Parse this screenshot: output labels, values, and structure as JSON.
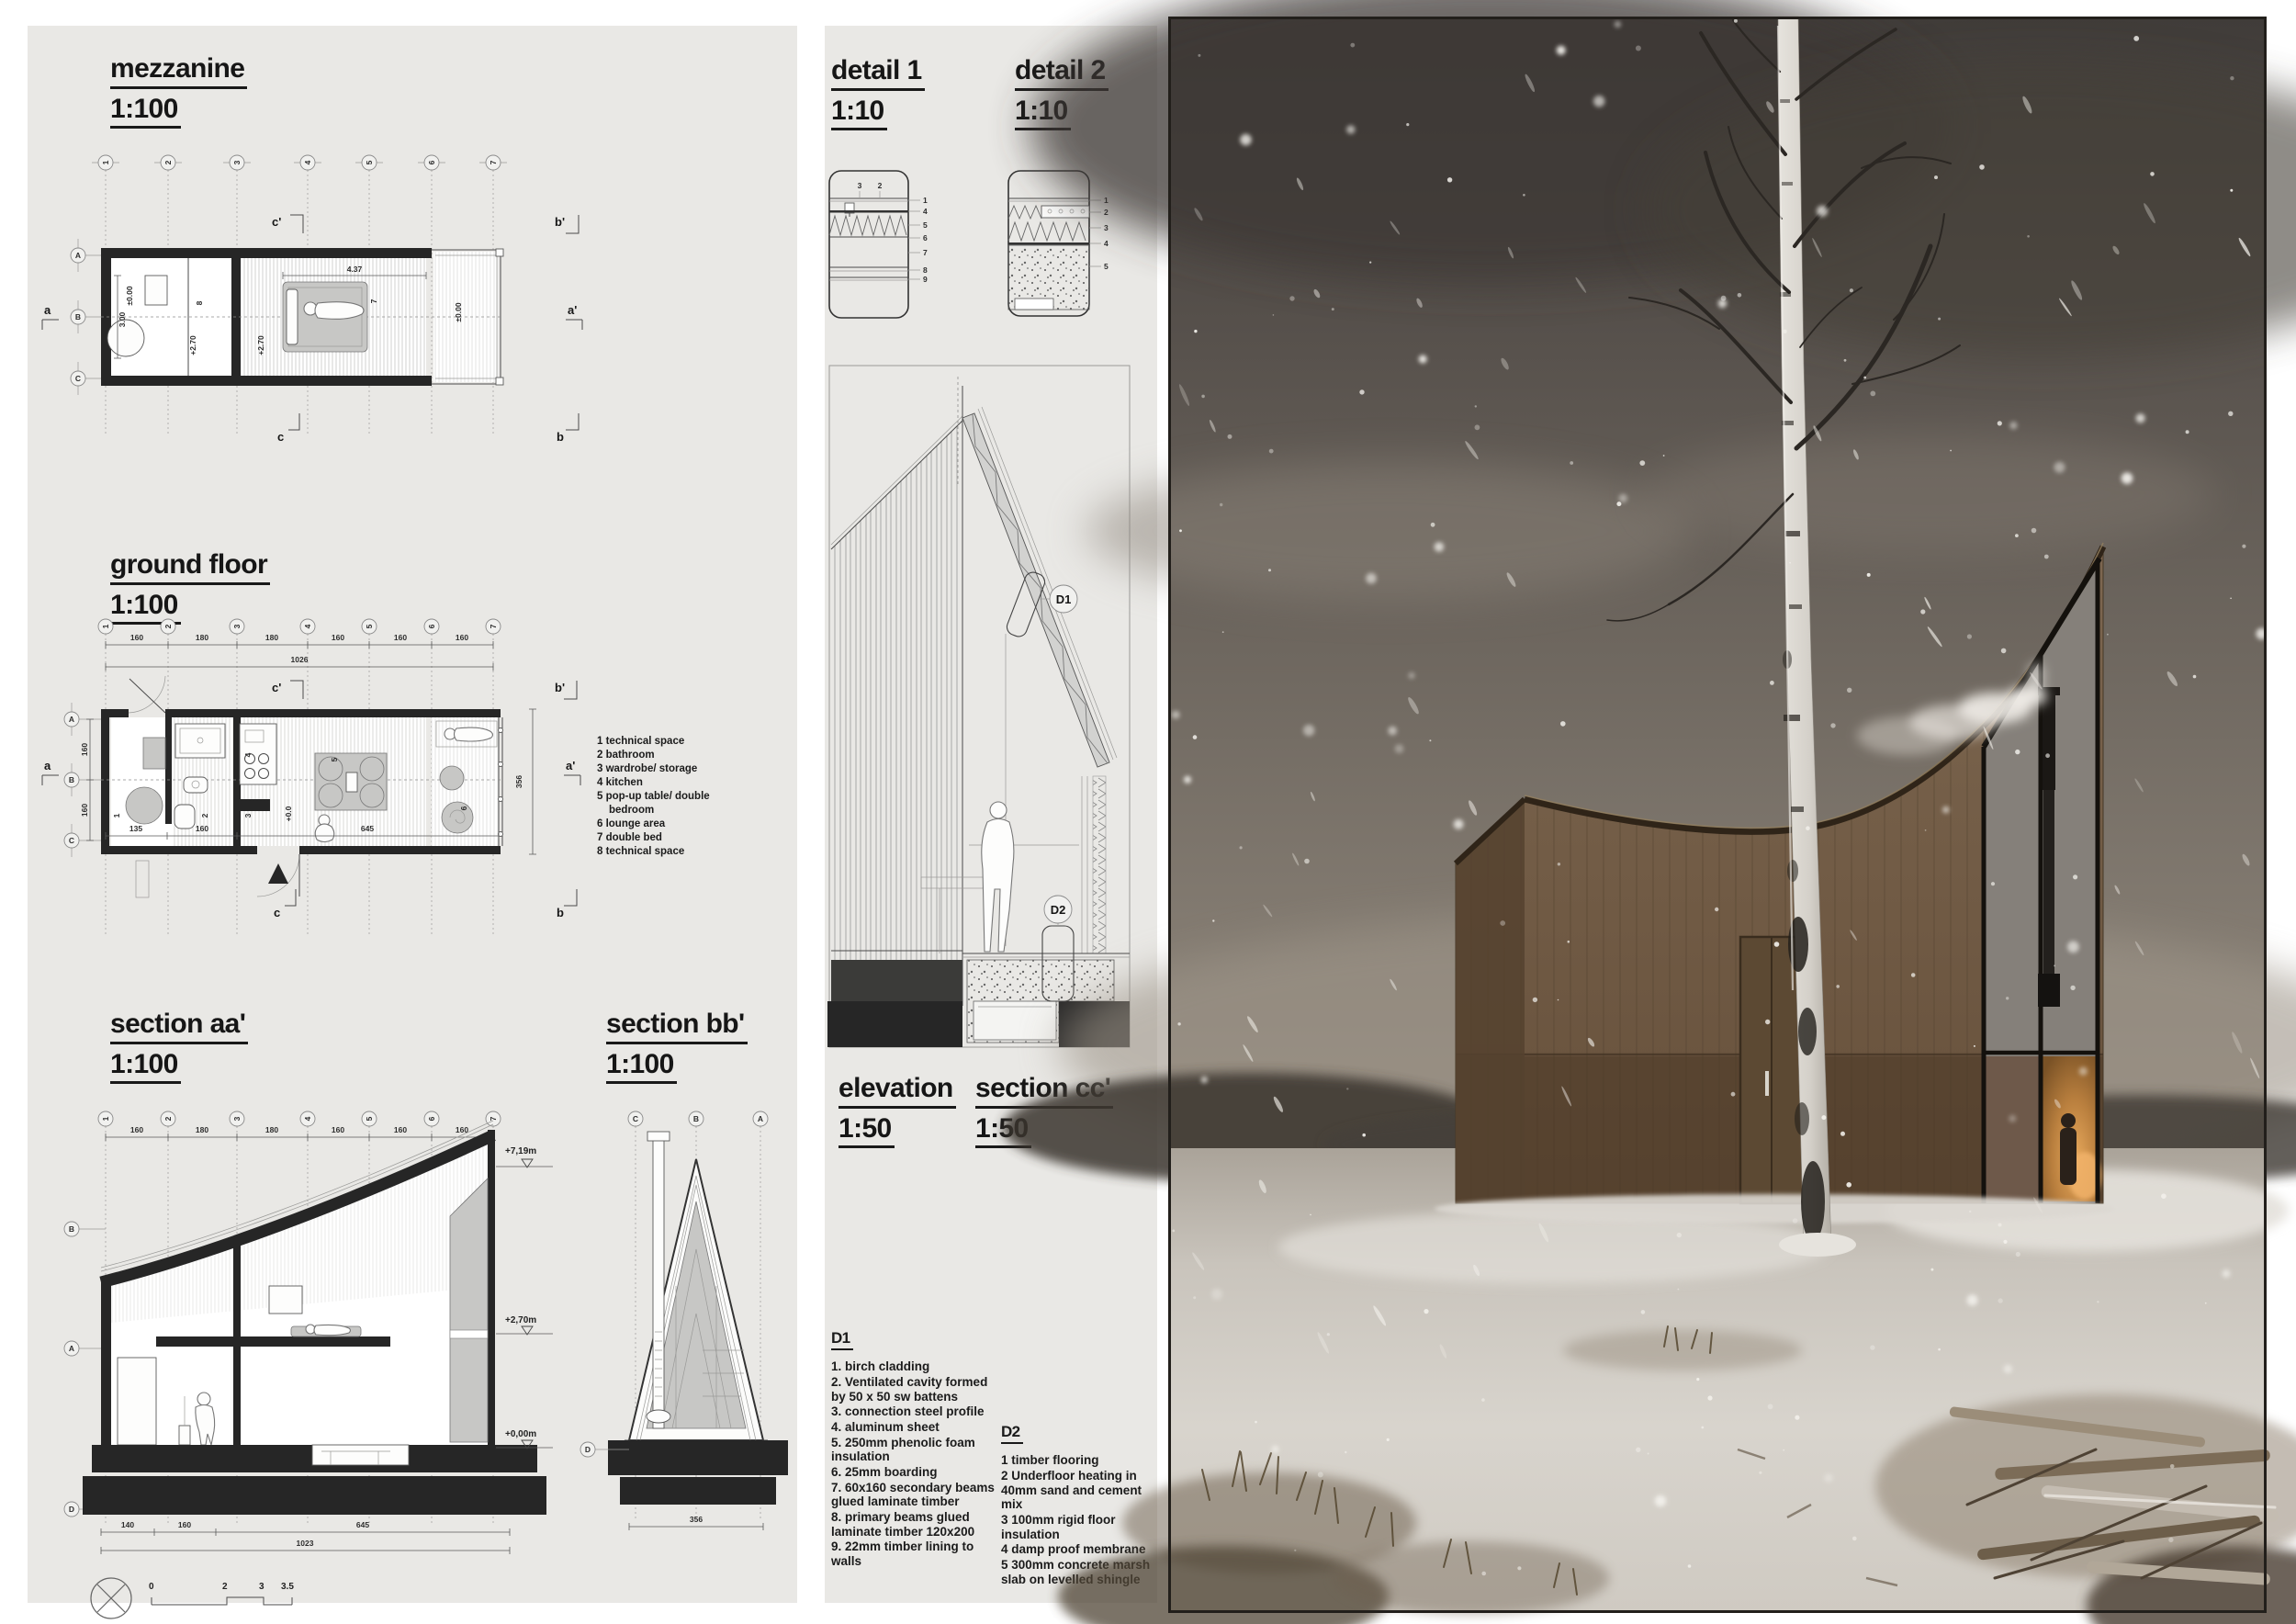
{
  "board": {
    "bg": "#ffffff",
    "panel_bg": "#e9e8e5"
  },
  "left": {
    "grid_numbers": [
      "1",
      "2",
      "3",
      "4",
      "5",
      "6",
      "7"
    ],
    "section_marks": {
      "a": "a",
      "ap": "a'",
      "b": "b",
      "bp": "b'",
      "c": "c",
      "cp": "c'"
    },
    "mezzanine": {
      "title": "mezzanine",
      "scale": "1:100",
      "row_letters": [
        "A",
        "B",
        "C"
      ],
      "labels": {
        "level_left": "±0.00",
        "dim_left": "3.00",
        "room8": "8",
        "level_mid": "+2.70",
        "level_right": "+2.70",
        "bed_dim": "4.37",
        "room7": "7",
        "level_annex": "±0.00"
      }
    },
    "ground": {
      "title": "ground floor",
      "scale": "1:100",
      "dims_top": [
        "160",
        "180",
        "180",
        "160",
        "160",
        "160"
      ],
      "dim_total": "1026",
      "row_letters": [
        "A",
        "B",
        "C"
      ],
      "dims_left": [
        "160",
        "160"
      ],
      "dim_left_inner": "300",
      "dims_bottom": [
        "135",
        "160",
        "645"
      ],
      "dim_right": "356",
      "level": "+0.0",
      "rooms": [
        "1",
        "2",
        "3",
        "4",
        "5",
        "6"
      ],
      "legend": [
        "1 technical space",
        "2 bathroom",
        "3 wardrobe/ storage",
        "4 kitchen",
        "5 pop-up table/ double bedroom",
        "6 lounge area",
        "7 double bed",
        "8 technical space"
      ]
    },
    "section_aa": {
      "title": "section aa'",
      "scale": "1:100",
      "dims_top": [
        "160",
        "180",
        "180",
        "160",
        "160",
        "160"
      ],
      "levels": [
        "+7,19m",
        "+2,70m",
        "+0,00m"
      ],
      "row_letters": [
        "B",
        "A",
        "D"
      ],
      "dims_bottom": [
        "140",
        "160",
        "645"
      ],
      "dim_total": "1023"
    },
    "section_bb": {
      "title": "section bb'",
      "scale": "1:100",
      "col_letters": [
        "C",
        "B",
        "A"
      ],
      "row_letter": "D",
      "dim_bottom": "356"
    },
    "scale_bar": {
      "labels": [
        "0",
        "2",
        "3",
        "3.5"
      ]
    }
  },
  "middle": {
    "detail1": {
      "title": "detail 1",
      "scale": "1:10",
      "top_labels": [
        "3",
        "2"
      ],
      "side_labels": [
        "1",
        "4",
        "5",
        "6",
        "7",
        "8",
        "9"
      ]
    },
    "detail2": {
      "title": "detail 2",
      "scale": "1:10",
      "side_labels": [
        "1",
        "2",
        "3",
        "4",
        "5"
      ]
    },
    "callouts": {
      "d1": "D1",
      "d2": "D2"
    },
    "elevation": {
      "title": "elevation",
      "scale": "1:50"
    },
    "section_cc": {
      "title": "section cc'",
      "scale": "1:50"
    },
    "d1_notes": {
      "heading": "D1",
      "items": [
        "1. birch cladding",
        "2. Ventilated cavity formed by 50 x 50 sw battens",
        "3. connection steel profile",
        "4. aluminum sheet",
        "5. 250mm phenolic foam insulation",
        "6. 25mm boarding",
        "7. 60x160 secondary beams glued laminate timber",
        "8. primary beams glued laminate timber 120x200",
        "9. 22mm timber lining to walls"
      ]
    },
    "d2_notes": {
      "heading": "D2",
      "items": [
        "1 timber flooring",
        "2 Underfloor heating in 40mm sand and cement mix",
        "3 100mm rigid floor insulation",
        "4 damp proof membrane",
        "5 300mm concrete marsh slab on levelled shingle"
      ]
    }
  },
  "photo": {
    "colors": {
      "sky_top": "#403c39",
      "sky_bottom": "#978e82",
      "snow": "#d8d4cd",
      "wood": "#7a644d",
      "wood_dark": "#4e3d2a",
      "window_glow": "#c98c49",
      "smoke": "#efece7",
      "birch": "#e3e0da"
    }
  }
}
